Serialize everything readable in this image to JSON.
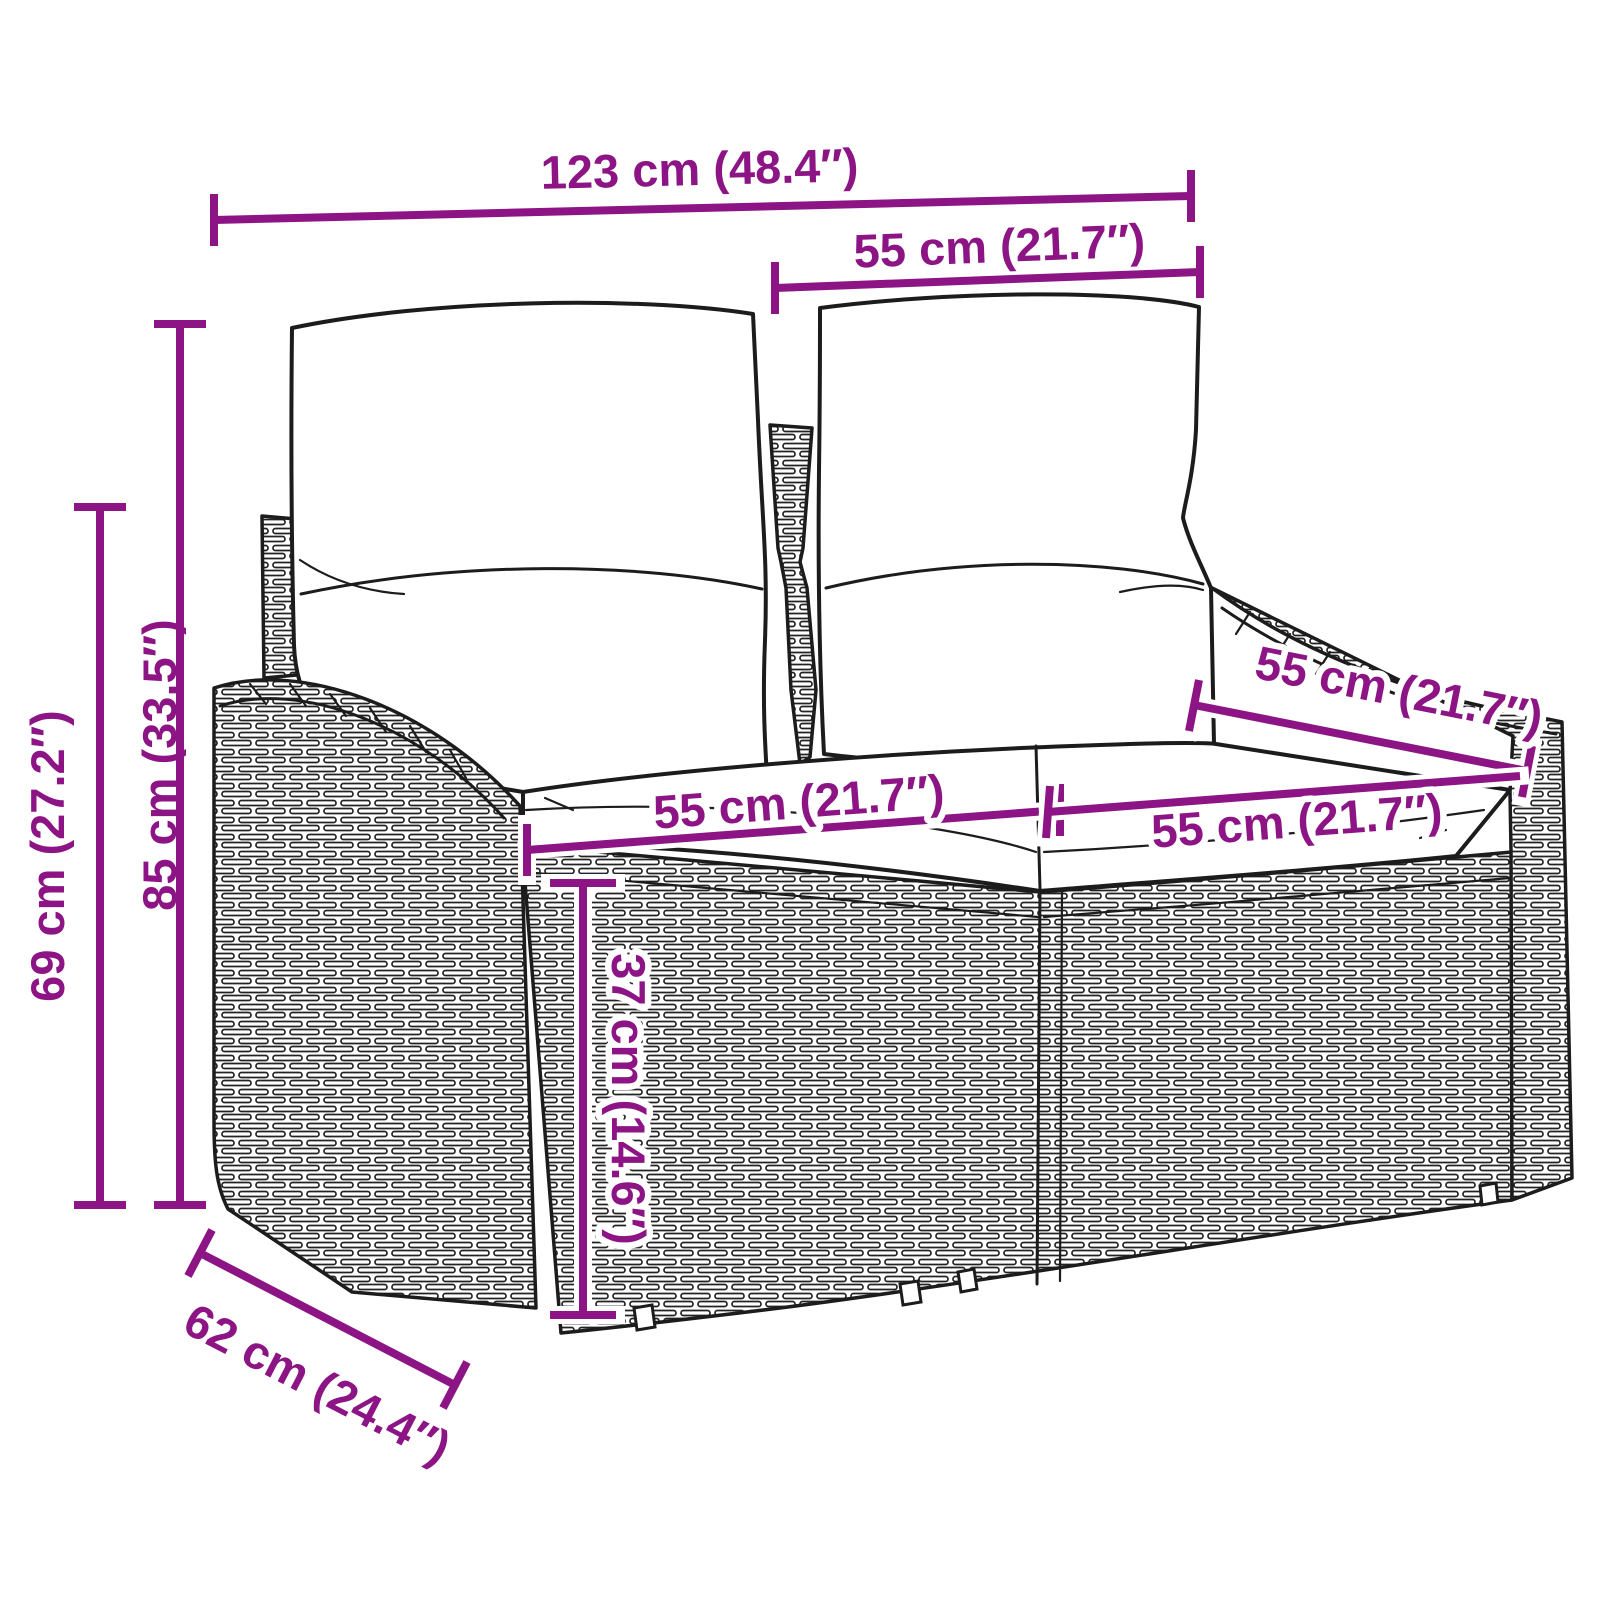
{
  "diagram": {
    "type": "product-dimension-diagram",
    "product": "rattan-2-seater-garden-sofa-with-cushions",
    "colors": {
      "accent": "#8C1484",
      "ink": "#1c1c1c",
      "bg": "#ffffff"
    },
    "dimensions": {
      "overall_width": {
        "label": "123 cm (48.4″)"
      },
      "backrest_width": {
        "label": "55 cm (21.7″)"
      },
      "total_height": {
        "label": "85 cm (33.5″)"
      },
      "frame_height": {
        "label": "69 cm (27.2″)"
      },
      "seat_height": {
        "label": "37 cm (14.6″)"
      },
      "backrest_depth": {
        "label": "55 cm (21.7″)"
      },
      "seat_width_left": {
        "label": "55 cm (21.7″)"
      },
      "seat_width_right": {
        "label": "55 cm (21.7″)"
      },
      "seat_depth": {
        "label": "62 cm (24.4″)"
      }
    }
  }
}
